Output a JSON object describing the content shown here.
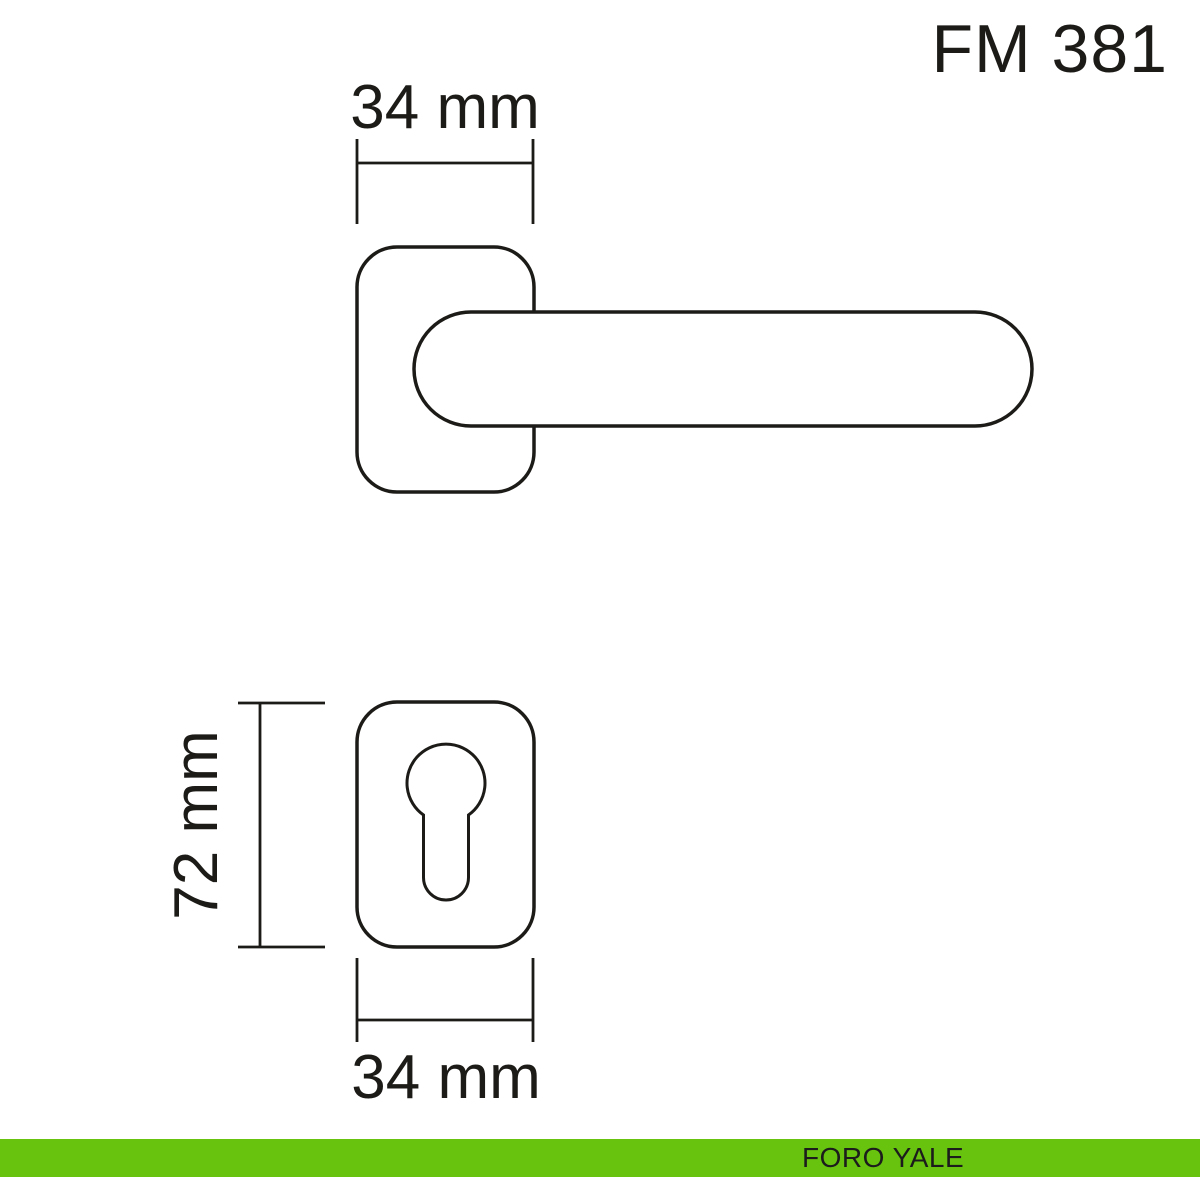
{
  "title": "FM 381",
  "diagram": {
    "dimensions": {
      "top_width": "34 mm",
      "left_height": "72 mm",
      "bottom_width": "34 mm"
    }
  },
  "footer": {
    "brand": "FORO YALE"
  },
  "colors": {
    "accent_green": "#67c30e",
    "ink": "#1d1b18",
    "background": "#ffffff"
  }
}
